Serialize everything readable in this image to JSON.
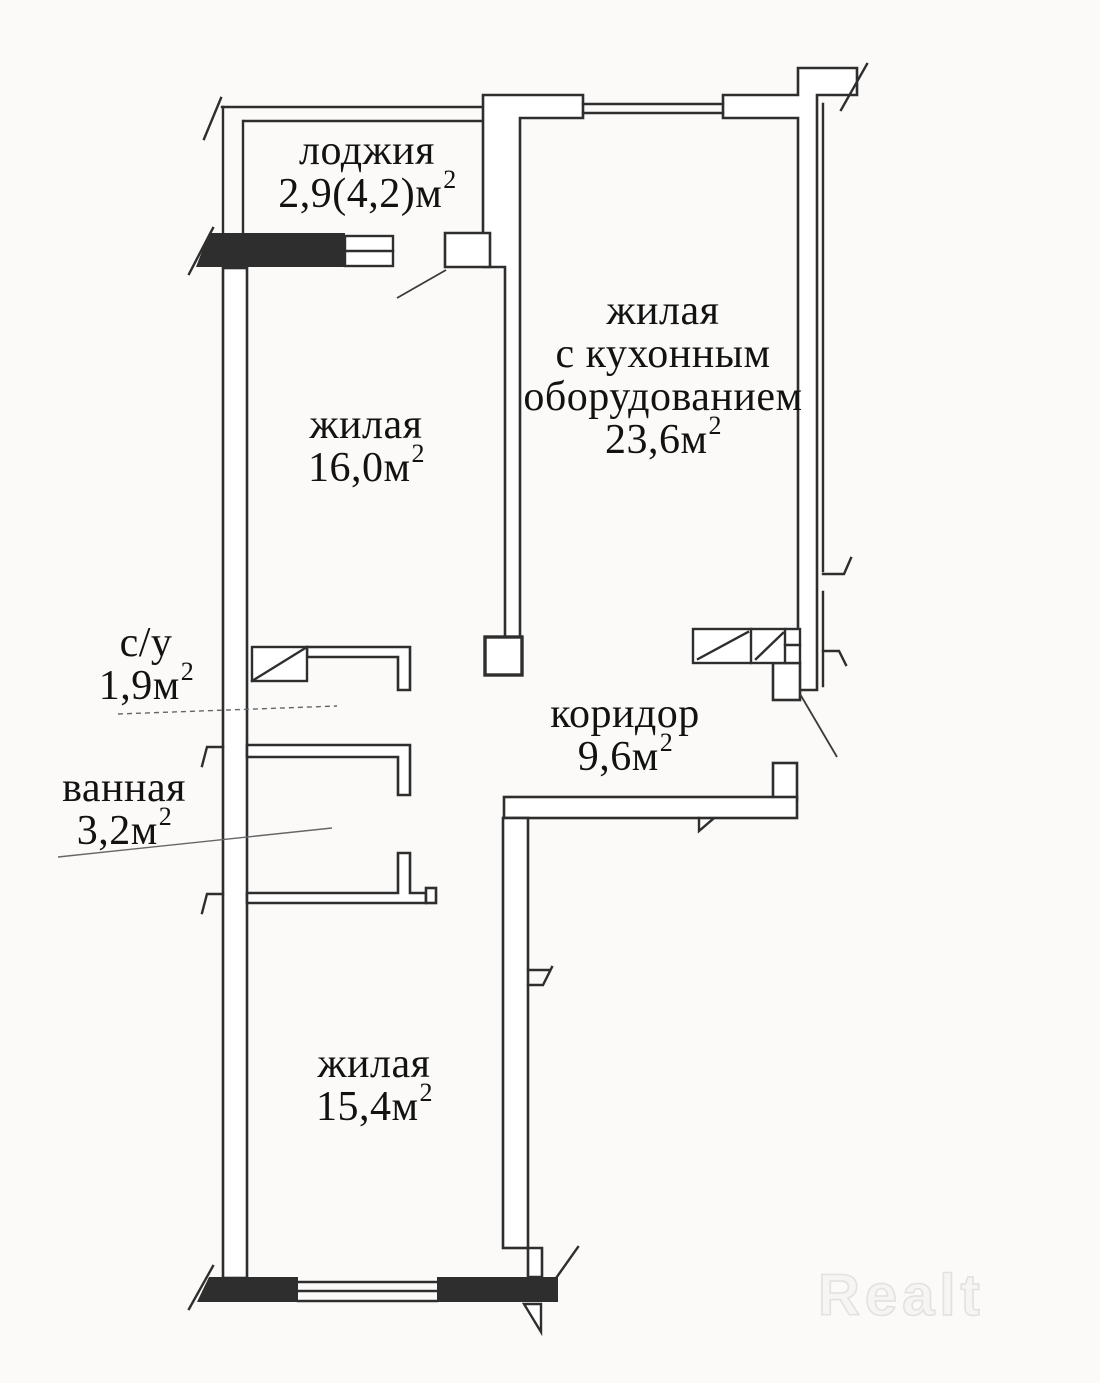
{
  "plan": {
    "background": "#fbfaf8",
    "wall_color": "#2e2e2e",
    "watermark_outline_color": "#e2e1de"
  },
  "rooms": [
    {
      "id": "loggia",
      "name": "лоджия",
      "area": "2,9(4,2)м",
      "sup": "2"
    },
    {
      "id": "living-16",
      "name": "жилая",
      "area": "16,0м",
      "sup": "2"
    },
    {
      "id": "living-kitchen",
      "line1": "жилая",
      "line2": "с кухонным",
      "line3": "оборудованием",
      "area": "23,6м",
      "sup": "2"
    },
    {
      "id": "wc",
      "name": "с/у",
      "area": "1,9м",
      "sup": "2"
    },
    {
      "id": "bathroom",
      "name": "ванная",
      "area": "3,2м",
      "sup": "2"
    },
    {
      "id": "corridor",
      "name": "коридор",
      "area": "9,6м",
      "sup": "2"
    },
    {
      "id": "living-15",
      "name": "жилая",
      "area": "15,4м",
      "sup": "2"
    }
  ],
  "watermark": {
    "text": "Realt"
  }
}
